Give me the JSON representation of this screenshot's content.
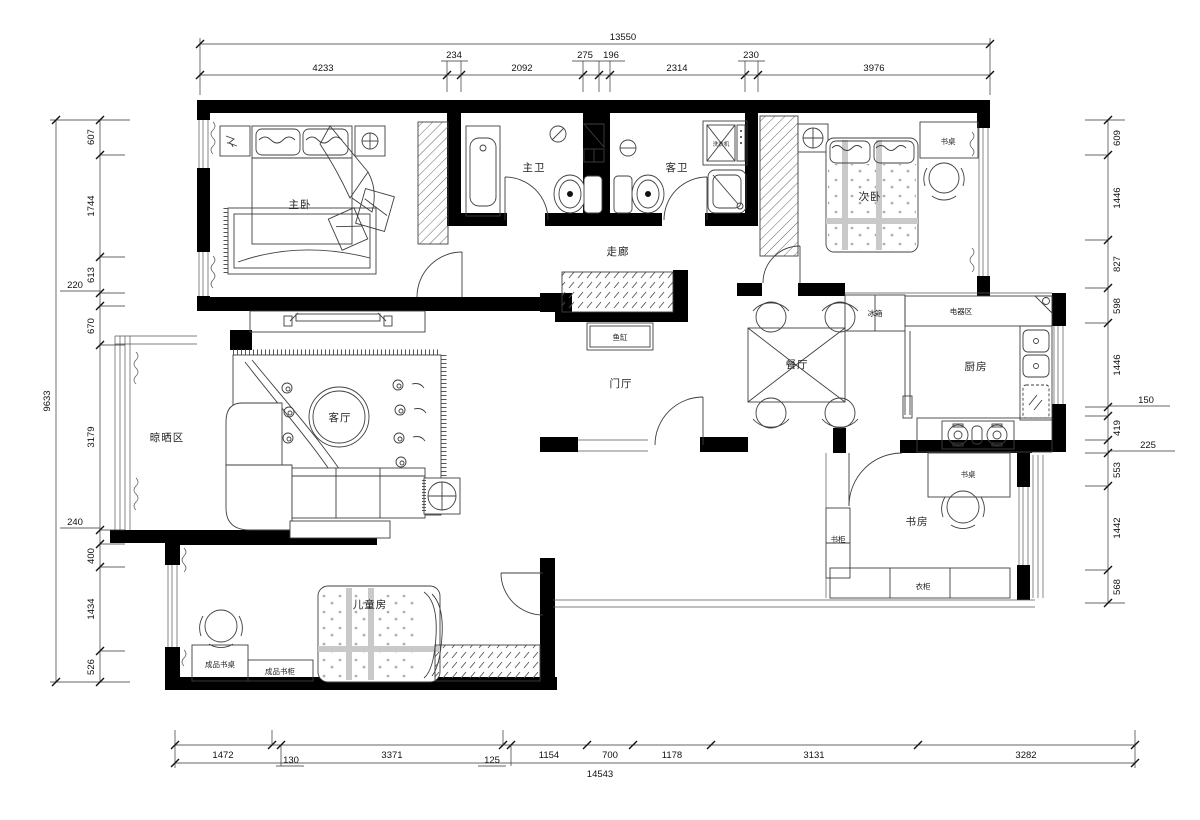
{
  "page": {
    "background": "#ffffff",
    "type": "residential floor plan"
  },
  "colors": {
    "wall": "#000000",
    "furniture_line": "#3f3f3f",
    "dimension": "#111111"
  },
  "labels": {
    "master_bedroom": "主卧",
    "master_bath": "主卫",
    "guest_bath": "客卫",
    "washer": "洗衣机",
    "corridor": "走廊",
    "second_bedroom": "次卧",
    "desk_second_bedroom": "书桌",
    "fridge": "冰箱",
    "appliance_area": "电器区",
    "kitchen": "厨房",
    "dining": "餐厅",
    "fish_tank": "鱼缸",
    "foyer": "门厅",
    "living": "客厅",
    "drying_area": "晾晒区",
    "kids_room": "儿童房",
    "kids_desk": "成品书桌",
    "kids_bookcase": "成品书柜",
    "study": "书房",
    "study_desk": "书桌",
    "bookcase": "书柜",
    "wardrobe": "衣柜"
  },
  "dims": {
    "top": {
      "total": "13550",
      "segments": [
        "4233",
        "234",
        "2092",
        "275",
        "196",
        "2314",
        "230",
        "3976"
      ]
    },
    "bottom": {
      "total": "14543",
      "segments": [
        "1472",
        "130",
        "3371",
        "125",
        "1154",
        "700",
        "1178",
        "3131",
        "3282"
      ]
    },
    "left": {
      "total": "9633",
      "segments": [
        "607",
        "1744",
        "613",
        "220",
        "670",
        "3179",
        "240",
        "400",
        "1434",
        "526"
      ]
    },
    "right": {
      "segments": [
        "609",
        "1446",
        "827",
        "598",
        "1446",
        "150",
        "419",
        "225",
        "553",
        "1442",
        "568"
      ]
    }
  }
}
